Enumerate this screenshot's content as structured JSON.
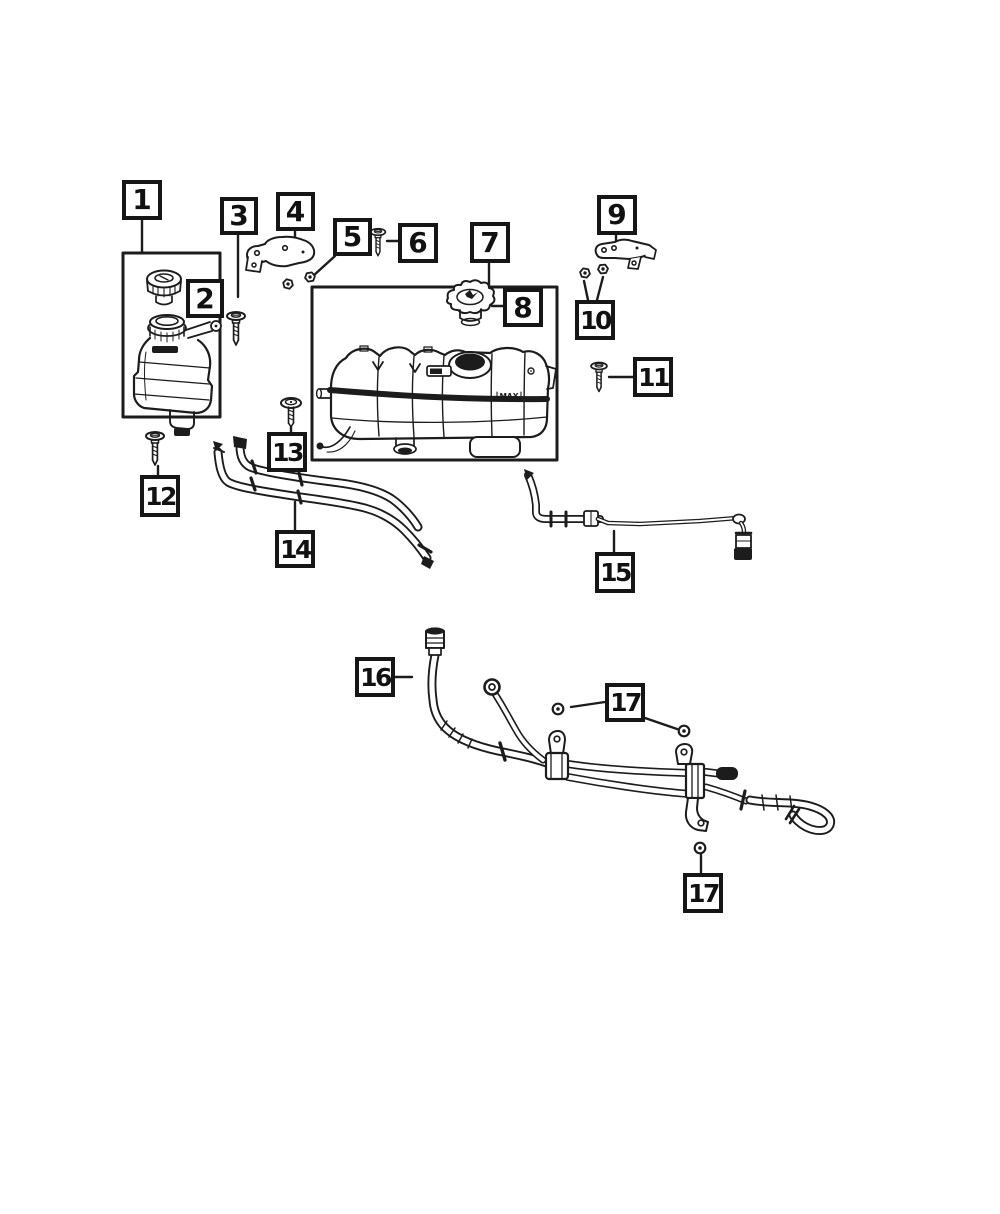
{
  "diagram": {
    "background_color": "#ffffff",
    "line_color": "#1c1c1c",
    "tank_max_label": "MAX",
    "callouts": [
      {
        "id": "1",
        "label": "1"
      },
      {
        "id": "2",
        "label": "2"
      },
      {
        "id": "3",
        "label": "3"
      },
      {
        "id": "4",
        "label": "4"
      },
      {
        "id": "5",
        "label": "5"
      },
      {
        "id": "6",
        "label": "6"
      },
      {
        "id": "7",
        "label": "7"
      },
      {
        "id": "8",
        "label": "8"
      },
      {
        "id": "9",
        "label": "9"
      },
      {
        "id": "10",
        "label": "10"
      },
      {
        "id": "11",
        "label": "11"
      },
      {
        "id": "12",
        "label": "12"
      },
      {
        "id": "13",
        "label": "13"
      },
      {
        "id": "14",
        "label": "14"
      },
      {
        "id": "15",
        "label": "15"
      },
      {
        "id": "16",
        "label": "16"
      },
      {
        "id": "17a",
        "label": "17"
      },
      {
        "id": "17b",
        "label": "17"
      }
    ]
  }
}
